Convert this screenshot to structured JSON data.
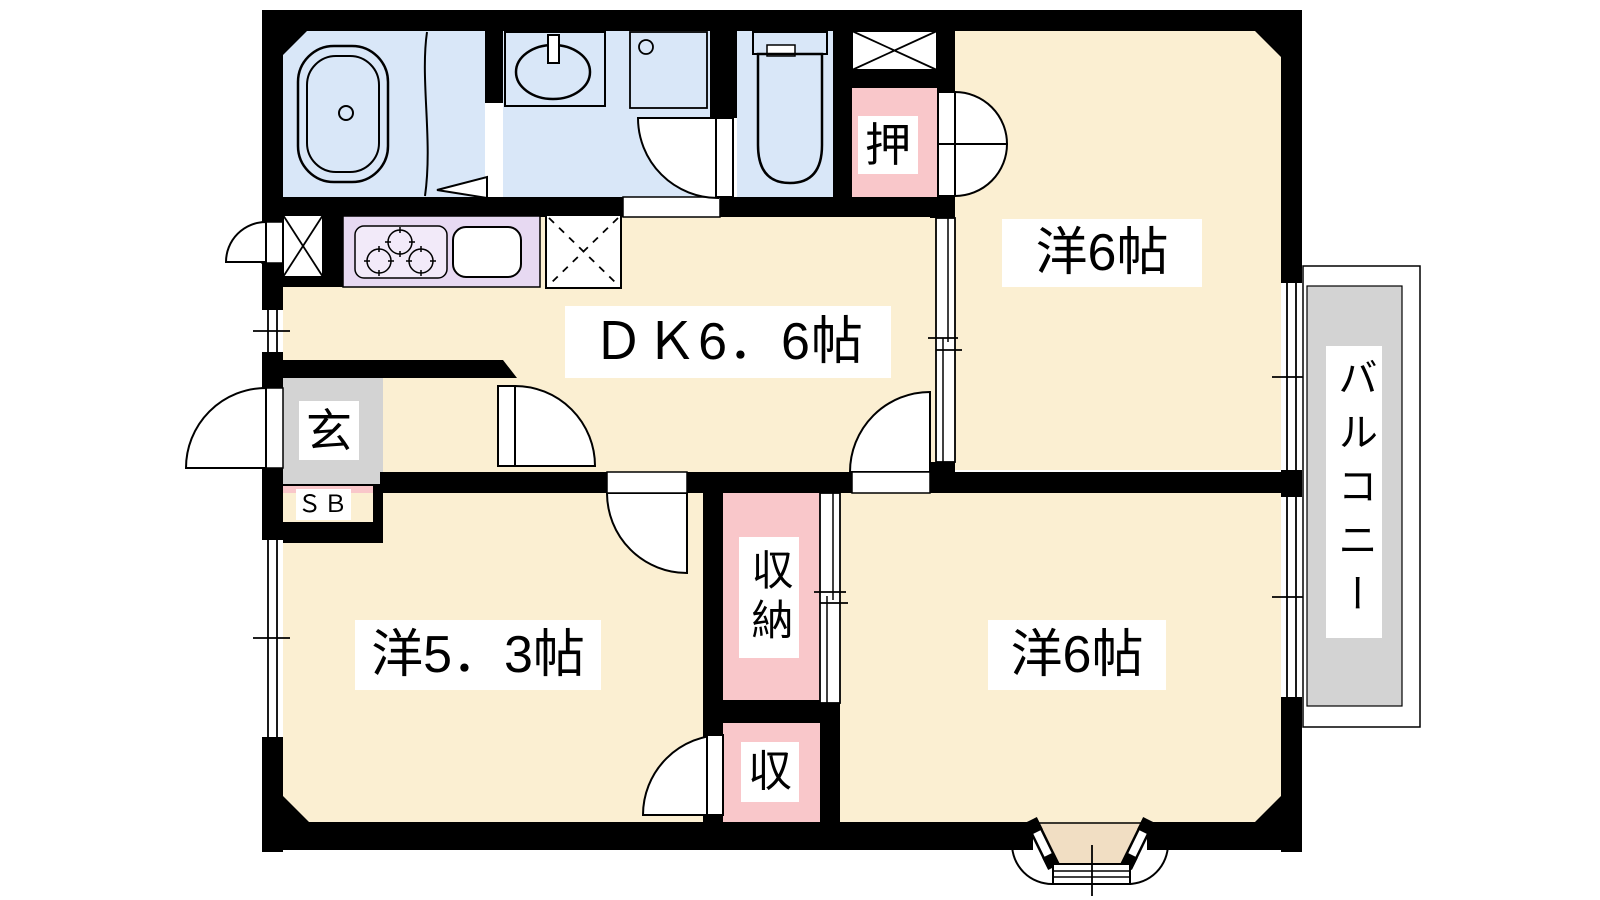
{
  "rooms": {
    "dining_kitchen": {
      "label": "ＤＫ6．6帖"
    },
    "western_room_top": {
      "label": "洋6帖"
    },
    "western_room_bottom": {
      "label": "洋6帖"
    },
    "western_room_small": {
      "label": "洋5．3帖"
    },
    "oshiire_closet": {
      "label": "押"
    },
    "entrance": {
      "label": "玄"
    },
    "shoe_box": {
      "label": "ＳＢ"
    },
    "storage_tall": {
      "label": "収納"
    },
    "storage_small": {
      "label": "収"
    },
    "balcony": {
      "label": "バルコニー"
    }
  },
  "colors": {
    "wall": "#000000",
    "room_floor": "#FBEFD2",
    "wet_area": "#D9E7F8",
    "kitchen_counter": "#E7D9F2",
    "closet": "#F9C7CA",
    "entrance_floor": "#D3D3D3",
    "balcony_floor": "#D3D3D3",
    "bay_window_floor": "#F1DEC3"
  }
}
